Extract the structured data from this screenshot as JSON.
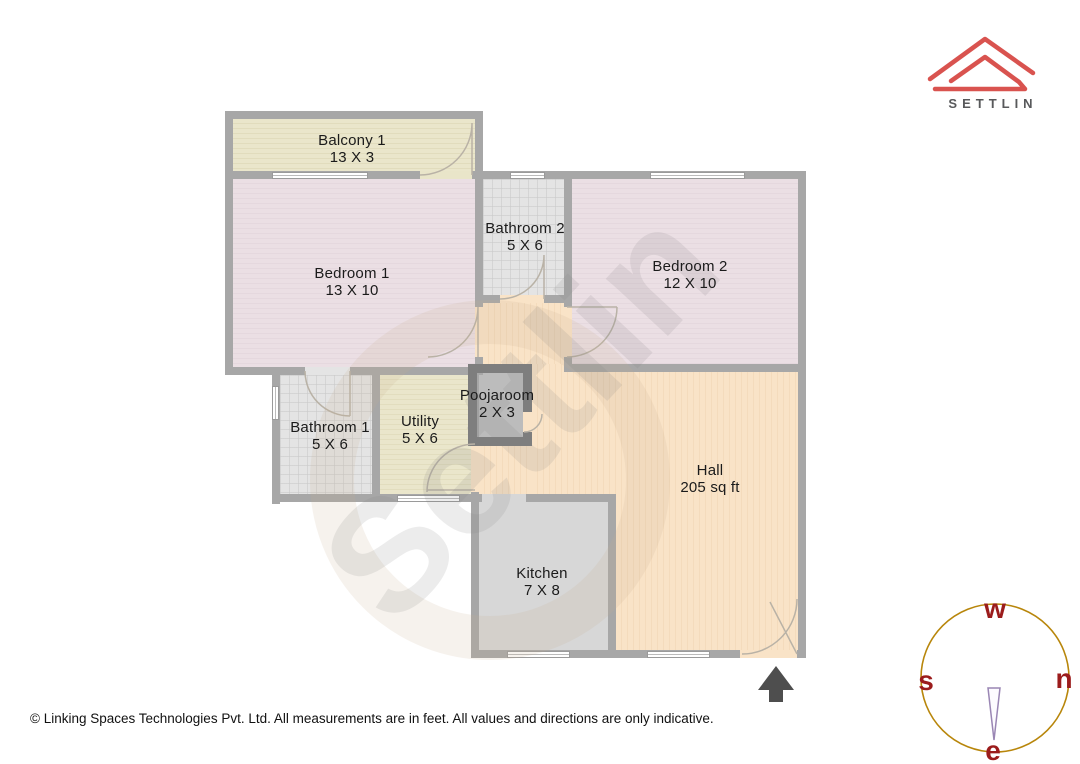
{
  "brand": {
    "wordmark": "SETTLIN",
    "logo_color": "#d9534f",
    "wordmark_color": "#58595b"
  },
  "watermark": {
    "text": "Settlin"
  },
  "rooms": [
    {
      "id": "balcony1",
      "label": "Balcony 1",
      "dim": "13 X 3"
    },
    {
      "id": "bedroom1",
      "label": "Bedroom 1",
      "dim": "13 X 10"
    },
    {
      "id": "bathroom2",
      "label": "Bathroom 2",
      "dim": "5 X 6"
    },
    {
      "id": "bedroom2",
      "label": "Bedroom 2",
      "dim": "12 X 10"
    },
    {
      "id": "bathroom1",
      "label": "Bathroom 1",
      "dim": "5 X 6"
    },
    {
      "id": "utility",
      "label": "Utility",
      "dim": "5 X 6"
    },
    {
      "id": "poojaroom",
      "label": "Poojaroom",
      "dim": "2 X 3"
    },
    {
      "id": "hall",
      "label": "Hall",
      "dim": "205 sq ft"
    },
    {
      "id": "kitchen",
      "label": "Kitchen",
      "dim": "7 X 8"
    }
  ],
  "compass": {
    "top": "w",
    "left": "s",
    "right": "n",
    "bottom": "e",
    "ring_color": "#b8860b",
    "letter_color": "#9b1c1c"
  },
  "footer": {
    "text": "© Linking Spaces Technologies Pvt. Ltd. All measurements are in feet. All values and directions are only indicative."
  }
}
